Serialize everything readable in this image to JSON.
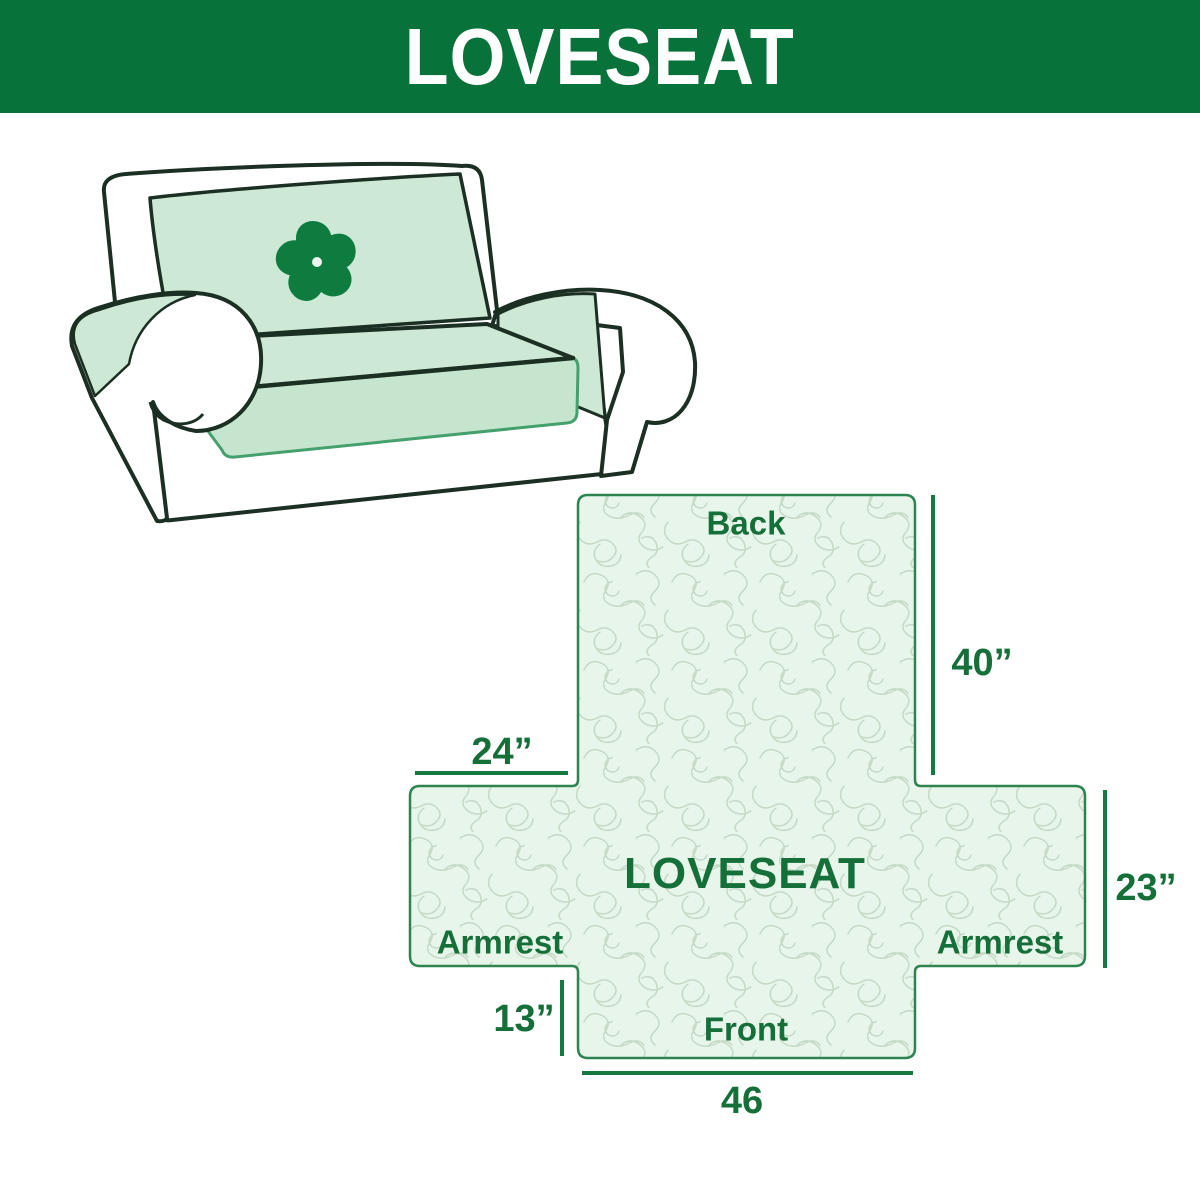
{
  "header": {
    "title": "LOVESEAT"
  },
  "sofa": {
    "logo_icon": "pinwheel-icon",
    "description": "loveseat-with-mint-slipcover"
  },
  "diagram": {
    "labels": {
      "back": "Back",
      "front": "Front",
      "armrest_left": "Armrest",
      "armrest_right": "Armrest",
      "center": "LOVESEAT"
    },
    "dimensions": {
      "back_height": "40”",
      "armrest_width": "24”",
      "seat_side": "23”",
      "front_height": "13”",
      "front_width": "46"
    }
  },
  "colors": {
    "banner_green": "#077239",
    "banner_text": "#ffffff",
    "label_green": "#156f39",
    "diagram_outline_green": "#2c8551",
    "diagram_fill_mint": "#e8f5ea",
    "pattern_line": "#c5d9c6",
    "dimension_line_green": "#17793f",
    "sofa_mint": "#cde9d5",
    "sofa_outline": "#1b2f23",
    "skirt_border_green": "#44a06c",
    "logo_green": "#0e7c3e"
  }
}
